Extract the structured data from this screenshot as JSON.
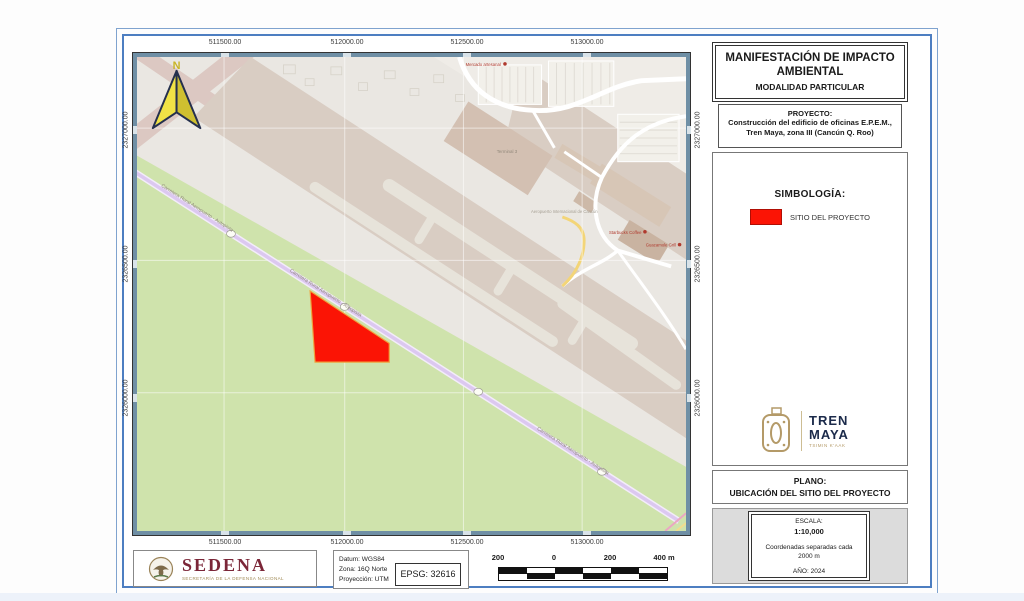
{
  "sheet": {
    "title": {
      "line1": "MANIFESTACIÓN DE IMPACTO",
      "line2": "AMBIENTAL",
      "modality": "MODALIDAD PARTICULAR"
    },
    "project": {
      "label": "PROYECTO:",
      "line1": "Construcción del edificio de oficinas E.P.E.M.,",
      "line2": "Tren Maya, zona III (Cancún Q. Roo)"
    },
    "symbology": {
      "heading": "SIMBOLOGÍA:",
      "site_label": "SITIO DEL PROYECTO",
      "site_color": "#fb1405"
    },
    "tren_maya_logo": {
      "line1": "TREN",
      "line2": "MAYA",
      "tagline": "TSIMIN K'AAK"
    },
    "plano": {
      "label": "PLANO:",
      "title": "UBICACIÓN DEL SITIO DEL PROYECTO"
    },
    "scale_block": {
      "label": "ESCALA:",
      "value": "1:10,000",
      "note1": "Coordenadas separadas cada",
      "note2": "2000 m",
      "year": "AÑO: 2024"
    }
  },
  "map": {
    "north": "N",
    "x_labels": [
      "511500.00",
      "512000.00",
      "512500.00",
      "513000.00"
    ],
    "y_labels": [
      "2327000.00",
      "2326500.00",
      "2326000.00"
    ],
    "road_label": "Carretera Rural Aeropuerto - Autopista",
    "place_labels": {
      "terminal": "Terminal 3",
      "airport": "Aeropuerto Internacional de Cancún",
      "poi1": "Starbucks Coffee",
      "poi2": "Guacamole Grill",
      "poi3": "Mercado artesanal"
    },
    "site_color": "#fb1405",
    "vegetation_color": "#cfe3ac",
    "runway_color": "#d9cdc3",
    "road_color": "#dcc8f0"
  },
  "footer": {
    "sedena": {
      "name": "SEDENA",
      "subtitle": "SECRETARÍA DE LA DEFENSA NACIONAL"
    },
    "datum": {
      "line1": "Datum: WGS84",
      "line2": "Zona: 16Q Norte",
      "line3": "Proyección: UTM"
    },
    "epsg": "EPSG: 32616",
    "scalebar": {
      "labels": [
        "200",
        "0",
        "200",
        "400 m"
      ]
    }
  }
}
